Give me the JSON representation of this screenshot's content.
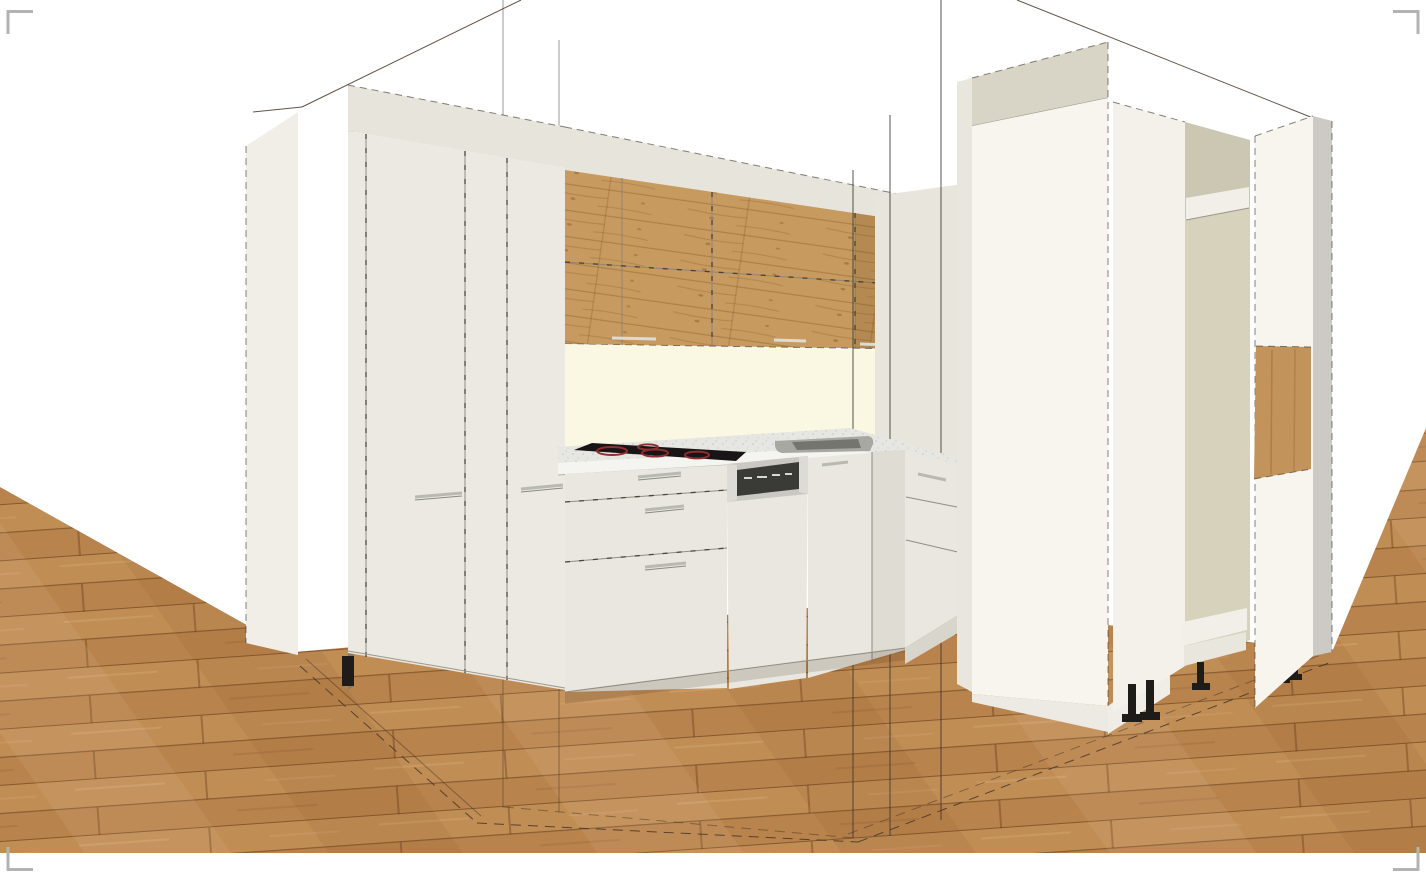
{
  "meta": {
    "view": "kitchen-3d-perspective-render",
    "description": "3D planner render of an L-shaped kitchen: tall cream cabinets left, oak-front wall cabinets, cooktop, sink, semi-integrated dishwasher, tall cabinet towers right (one open with shelves and adjustable feet), oak plank floor, room wireframe lines, viewport crop marks"
  },
  "colors": {
    "floor_a": "#c08d55",
    "floor_b": "#b8834c",
    "wood": "#c79a5f",
    "wood_niche": "#c2935a",
    "cream": "#e7e4db",
    "cream_front": "#ebe9e1",
    "cream_base": "#e9e7df",
    "side_panel": "#f0eee6",
    "return_panel": "#e8e5dc",
    "white_panel": "#f7f5ee",
    "white_soft": "#f3f1e9",
    "greige_band": "#d8d4c6",
    "beige_interior": "#d6d2bc",
    "ivory_splash": "#faf7e3",
    "counter": "#e6e6e2",
    "counter_edge": "#f4f4f0",
    "steel": "#c9c8c2",
    "steel_light": "#dcdbd5",
    "appliance_window": "#3a3a36",
    "cooktop_black": "#191415",
    "burner_red": "#8f2f2f",
    "sink_gray": "#a8a8a2",
    "sink_inner": "#75756f",
    "shelf_white": "#f1efe7",
    "edge_gray": "#cbcac4",
    "foot_black": "#1e1c19",
    "wireframe": "#3b362f",
    "outline": "#453527",
    "handle": "#b9b9b3",
    "corner_mark": "#b3b3b3",
    "edge_strip": "#8a7a5e",
    "plinth": "#d8d5cc"
  },
  "scene": {
    "floor": {
      "label": "Oak plank floor"
    },
    "wireframe": {
      "label": "Room wireframe guides"
    },
    "left_panel": {
      "label": "Tall unit side panel"
    },
    "left_tall": {
      "label": "Tall cabinet unit (two doors)"
    },
    "wall_wood": {
      "label": "Wall cabinets with oak fronts"
    },
    "splash": {
      "label": "Backsplash"
    },
    "return_panel": {
      "label": "Return wall panel"
    },
    "counter": {
      "label": "Countertop"
    },
    "cooktop": {
      "label": "Ceramic cooktop"
    },
    "sink": {
      "label": "Sink"
    },
    "drawers": {
      "label": "Drawer base unit"
    },
    "dishwasher": {
      "label": "Semi-integrated dishwasher"
    },
    "base_door": {
      "label": "Base cabinet door"
    },
    "corner_base": {
      "label": "Corner base unit"
    },
    "tower_closed": {
      "label": "Tall cabinet tower (closed)"
    },
    "tower_open": {
      "label": "Tall cabinet tower (open carcass with shelves)"
    },
    "end_panel": {
      "label": "Tall end panel with oak niche"
    },
    "feet": {
      "label": "Adjustable plinth feet"
    },
    "marks": {
      "label": "Viewport corner marks"
    }
  }
}
